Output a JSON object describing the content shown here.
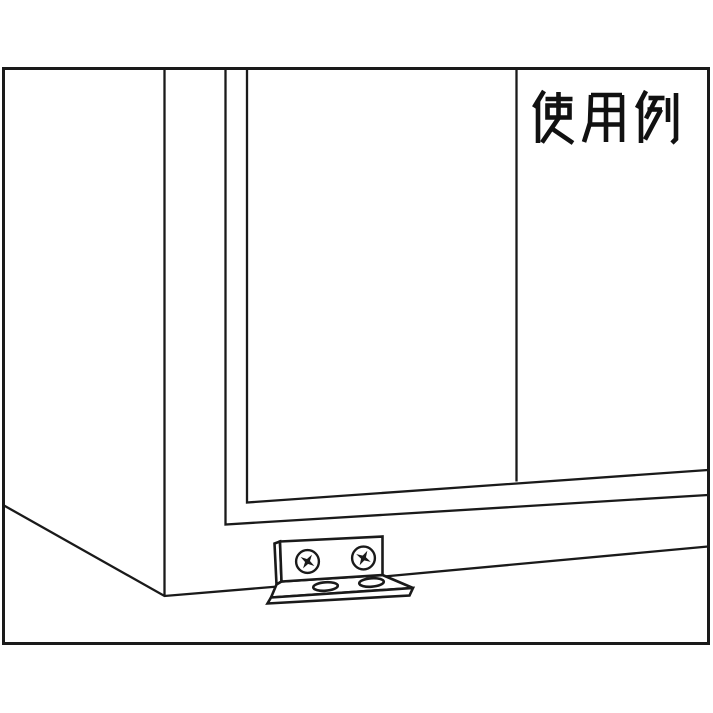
{
  "illustration": {
    "label": "使用例",
    "line_color": "#1a1a1a",
    "background_color": "#ffffff",
    "objects": [
      "cabinet corner in perspective with border frame",
      "two sliding door panels",
      "L-shaped angle bracket mounted at base",
      "two phillips screws on bracket face",
      "two oval holes on bracket flange"
    ]
  }
}
